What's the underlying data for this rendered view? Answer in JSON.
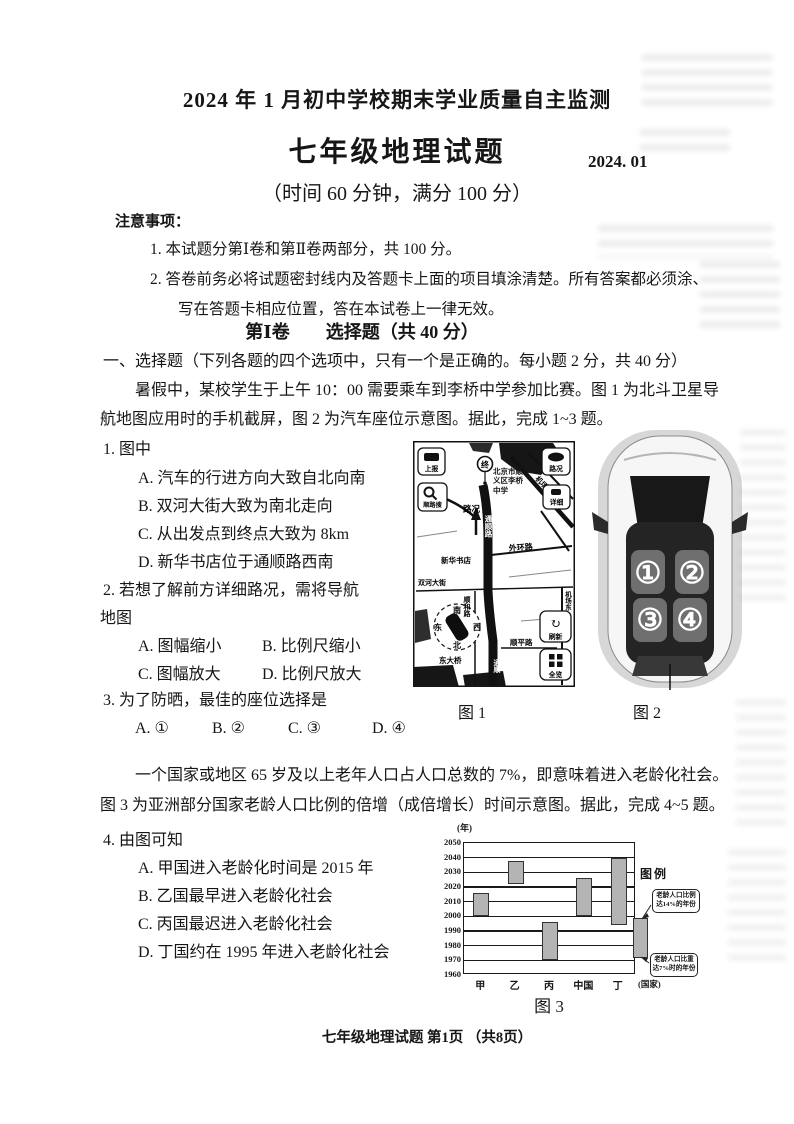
{
  "page": {
    "title": "2024 年 1 月初中学校期末学业质量自主监测",
    "subject_title": "七年级地理试题",
    "date": "2024. 01",
    "meta": "（时间 60 分钟，满分 100 分）",
    "footer": "七年级地理试题 第1页 （共8页）"
  },
  "notice": {
    "label": "注意事项：",
    "items": [
      "1. 本试题分第Ⅰ卷和第Ⅱ卷两部分，共 100 分。",
      "2. 答卷前务必将试题密封线内及答题卡上面的项目填涂清楚。所有答案都必须涂、",
      "写在答题卡相应位置，答在本试卷上一律无效。"
    ]
  },
  "section1": {
    "heading": "第Ⅰ卷　　选择题（共 40 分）",
    "intro": "一、选择题（下列各题的四个选项中，只有一个是正确的。每小题 2 分，共 40 分）",
    "passage_line1": "暑假中，某校学生于上午 10：00 需要乘车到李桥中学参加比赛。图 1 为北斗卫星导",
    "passage_line2": "航地图应用时的手机截屏，图 2 为汽车座位示意图。据此，完成 1~3 题。"
  },
  "q1": {
    "stem": "1. 图中",
    "options": [
      "A. 汽车的行进方向大致自北向南",
      "B. 双河大街大致为南北走向",
      "C. 从出发点到终点大致为 8km",
      "D. 新华书店位于通顺路西南"
    ]
  },
  "q2": {
    "stem_line1": "2. 若想了解前方详细路况，需将导航",
    "stem_line2": "地图",
    "options": [
      "A. 图幅缩小",
      "B. 比例尺缩小",
      "C. 图幅放大",
      "D. 比例尺放大"
    ]
  },
  "q3": {
    "stem": "3. 为了防晒，最佳的座位选择是",
    "options": [
      "A. ①",
      "B. ②",
      "C. ③",
      "D. ④"
    ]
  },
  "figure1": {
    "caption": "图 1",
    "buttons": {
      "report": "上报",
      "traffic": "路况",
      "route_search": "顺路搜",
      "detail": "详细",
      "refresh": "刷新",
      "overview": "全览"
    },
    "labels": {
      "pin": "终",
      "destination": "北京市顺义区李桥中学",
      "traffic_status": "路况",
      "road_tongshun": "通顺路",
      "road_waihuan": "外环路",
      "bookstore": "新华书店",
      "road_shuanghe": "双河大街",
      "road_jichangdong_diag": "机场东路",
      "road_jichangdong_side": "机场东",
      "road_shunhe": "顺和路",
      "road_shunping": "顺平路",
      "bridge": "东大桥",
      "road_tongshun_bottom": "通顺",
      "compass_s": "南",
      "compass_e": "东",
      "compass_w": "西",
      "compass_n": "北"
    }
  },
  "figure2": {
    "caption": "图 2",
    "seats": [
      "①",
      "②",
      "③",
      "④"
    ]
  },
  "passage2": {
    "line1": "一个国家或地区 65 岁及以上老年人口占人口总数的 7%，即意味着进入老龄化社会。",
    "line2": "图 3 为亚洲部分国家老龄人口比例的倍增（成倍增长）时间示意图。据此，完成 4~5 题。"
  },
  "q4": {
    "stem": "4. 由图可知",
    "options": [
      "A. 甲国进入老龄化时间是 2015 年",
      "B. 乙国最早进入老龄化社会",
      "C. 丙国最迟进入老龄化社会",
      "D. 丁国约在 1995 年进入老龄化社会"
    ]
  },
  "chart_data": {
    "type": "bar",
    "subtype": "floating-range-bars",
    "title": "图 3",
    "caption": "图 3",
    "ylabel": "(年)",
    "x_unit_label": "(国家)",
    "categories": [
      "甲",
      "乙",
      "丙",
      "中国",
      "丁"
    ],
    "series": [
      {
        "name": "老龄人口比重由7%升至14%的年份区间",
        "start_year": [
          2000,
          2022,
          1970,
          2000,
          1994
        ],
        "end_year": [
          2016,
          2038,
          1996,
          2026,
          2040
        ]
      }
    ],
    "ylim": [
      1960,
      2050
    ],
    "yticks": [
      2050,
      2040,
      2030,
      2020,
      2010,
      2000,
      1990,
      1980,
      1970,
      1960
    ],
    "grid": true,
    "legend": {
      "title": "图例",
      "position": "right",
      "top_note": "老龄人口比例达14%的年份",
      "bottom_note": "老龄人口比重达7%时的年份"
    },
    "bar_color": "#b4b4b4"
  }
}
